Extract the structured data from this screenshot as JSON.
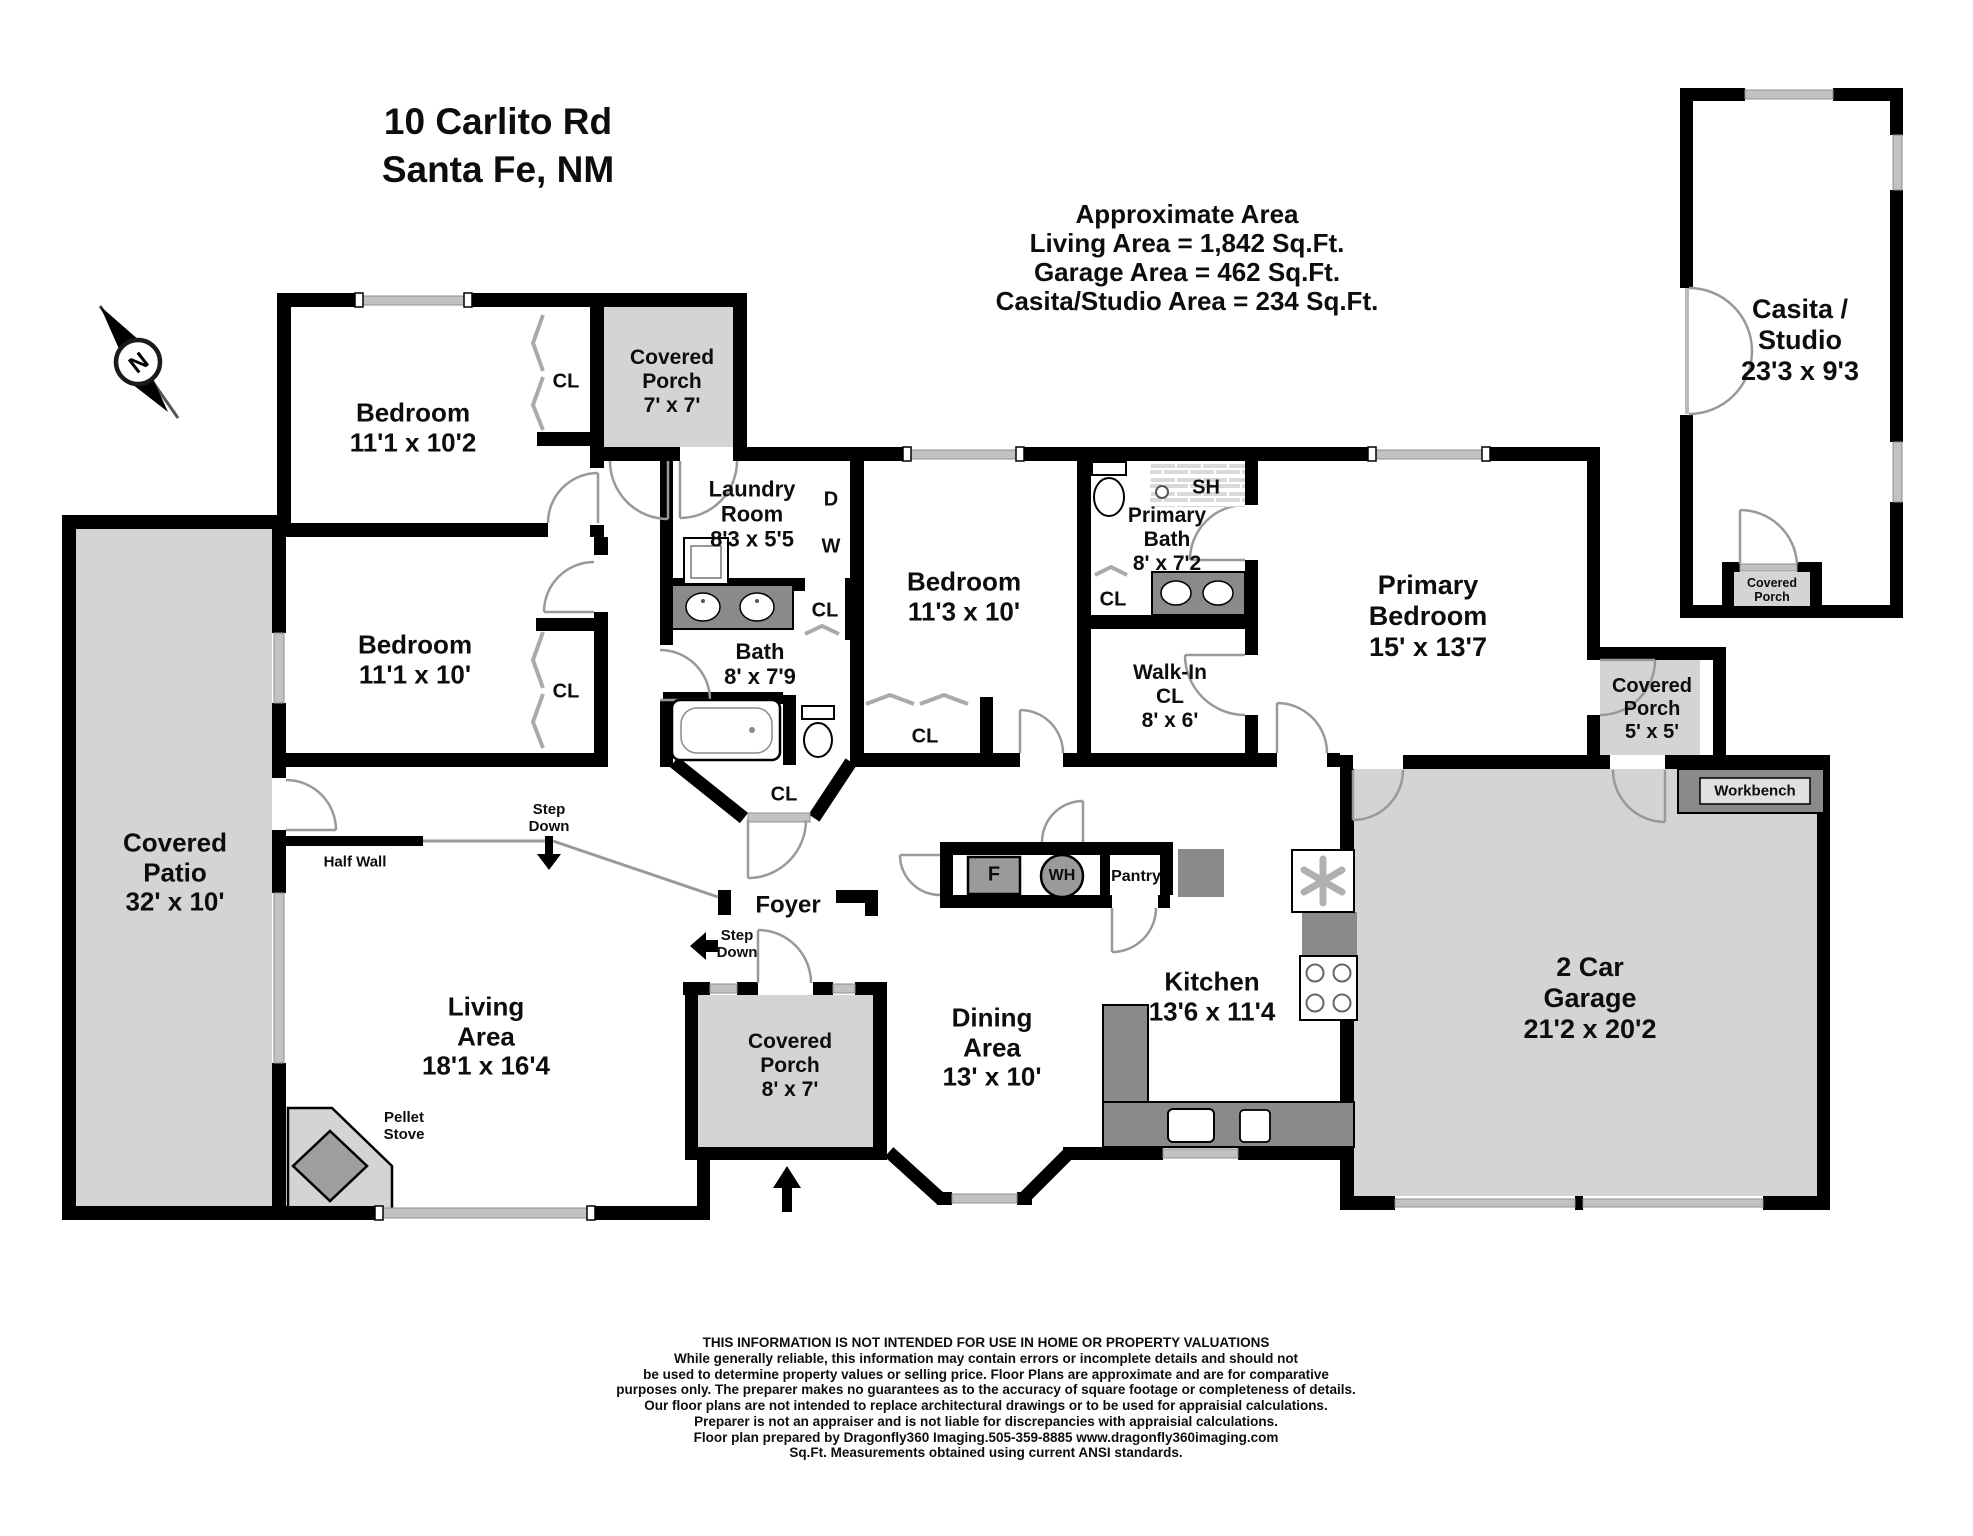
{
  "title": {
    "address_line1": "10 Carlito Rd",
    "address_line2": "Santa Fe, NM"
  },
  "area_summary": {
    "heading": "Approximate Area",
    "living": "Living Area = 1,842 Sq.Ft.",
    "garage": "Garage Area = 462 Sq.Ft.",
    "casita": "Casita/Studio Area = 234 Sq.Ft."
  },
  "compass": {
    "north": "N"
  },
  "rooms": {
    "bedroom_top": {
      "name": "Bedroom",
      "dims": "11'1 x 10'2"
    },
    "bedroom_mid": {
      "name": "Bedroom",
      "dims": "11'1 x 10'"
    },
    "bedroom_center": {
      "name": "Bedroom",
      "dims": "11'3 x 10'"
    },
    "primary_bedroom": {
      "name": "Primary Bedroom",
      "dims": "15' x 13'7"
    },
    "primary_bath": {
      "name": "Primary Bath",
      "dims": "8' x 7'2"
    },
    "bath": {
      "name": "Bath",
      "dims": "8' x 7'9"
    },
    "laundry": {
      "name": "Laundry Room",
      "dims": "8'3 x 5'5"
    },
    "walk_in_closet": {
      "name": "Walk-In CL",
      "dims": "8' x 6'"
    },
    "kitchen": {
      "name": "Kitchen",
      "dims": "13'6 x 11'4"
    },
    "dining": {
      "name": "Dining Area",
      "dims": "13' x 10'"
    },
    "living": {
      "name": "Living Area",
      "dims": "18'1 x 16'4"
    },
    "garage": {
      "name": "2 Car Garage",
      "dims": "21'2 x 20'2"
    },
    "casita": {
      "name": "Casita / Studio",
      "dims": "23'3 x 9'3"
    },
    "covered_patio": {
      "name": "Covered Patio",
      "dims": "32' x 10'"
    },
    "covered_porch_top": {
      "name": "Covered Porch",
      "dims": "7' x 7'"
    },
    "covered_porch_entry": {
      "name": "Covered Porch",
      "dims": "8' x 7'"
    },
    "covered_porch_primary": {
      "name": "Covered Porch",
      "dims": "5' x 5'"
    },
    "covered_porch_casita": {
      "name": "Covered Porch"
    },
    "foyer": {
      "name": "Foyer"
    }
  },
  "labels": {
    "closet": "CL",
    "shower": "SH",
    "dryer": "D",
    "washer": "W",
    "fridge": "F",
    "water_heater": "WH",
    "pantry": "Pantry",
    "workbench": "Workbench",
    "half_wall": "Half Wall",
    "step_down": "Step Down",
    "pellet_stove": "Pellet Stove"
  },
  "disclaimer": {
    "line1": "THIS INFORMATION IS NOT INTENDED FOR USE IN HOME OR PROPERTY VALUATIONS",
    "line2": "While generally reliable, this information may contain errors or incomplete details and should not",
    "line3": "be used to determine property values or selling price. Floor Plans are approximate and are for comparative",
    "line4": "purposes only. The preparer makes no guarantees as to the accuracy of square footage or completeness of details.",
    "line5": "Our floor plans are not intended to replace architectural drawings or to be used for appraisial calculations.",
    "line6": "Preparer is not an appraiser and is not liable for discrepancies with appraisial calculations.",
    "line7": "Floor plan prepared by Dragonfly360 Imaging.505-359-8885  www.dragonfly360imaging.com",
    "line8": "Sq.Ft. Measurements obtained using current ANSI standards."
  },
  "colors": {
    "wall": "#000000",
    "outdoor_fill": "#d4d4d4",
    "counter_fill": "#8a8a8a",
    "window": "#c2c2c2"
  }
}
